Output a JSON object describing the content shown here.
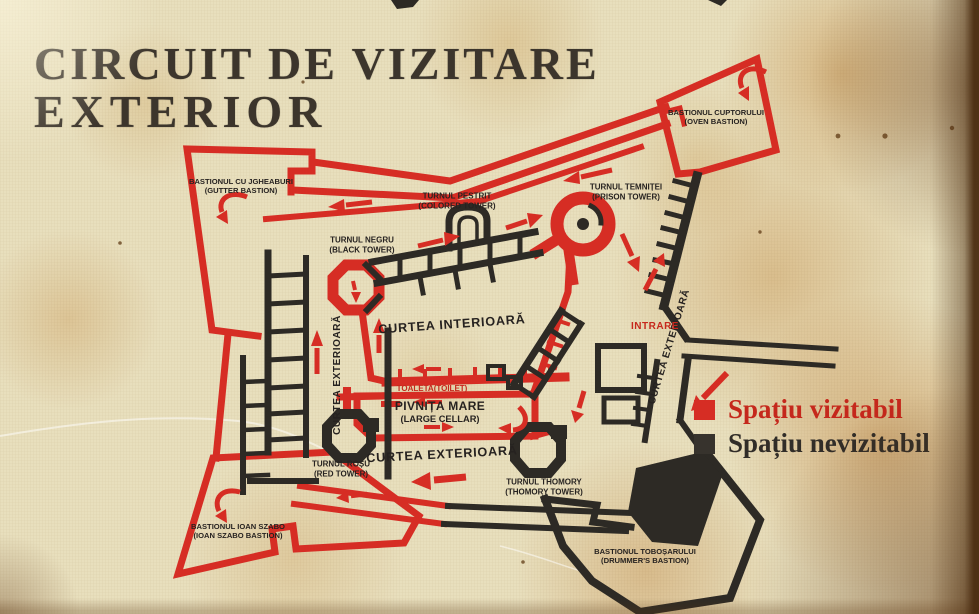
{
  "title": {
    "line1": "CIRCUIT DE VIZITARE",
    "line2": "EXTERIOR"
  },
  "legend": {
    "items": [
      {
        "label": "Spațiu vizitabil",
        "color": "#d62d24"
      },
      {
        "label": "Spațiu nevizitabil",
        "color": "#37332d"
      }
    ]
  },
  "map": {
    "labels": {
      "gutter": {
        "l1": "BASTIONUL CU JGHEABURI",
        "l2": "(GUTTER BASTION)"
      },
      "oven": {
        "l1": "BASTIONUL CUPTORULUI",
        "l2": "(OVEN BASTION)"
      },
      "colored": {
        "l1": "TURNUL PESTRIT",
        "l2": "(COLORED TOWER)"
      },
      "prison": {
        "l1": "TURNUL TEMNIȚEI",
        "l2": "(PRISON TOWER)"
      },
      "black": {
        "l1": "TURNUL NEGRU",
        "l2": "(BLACK TOWER)"
      },
      "red": {
        "l1": "TURNUL ROȘU",
        "l2": "(RED TOWER)"
      },
      "thomory": {
        "l1": "TURNUL THOMORY",
        "l2": "(THOMORY TOWER)"
      },
      "szabo": {
        "l1": "BASTIONUL IOAN SZABO",
        "l2": "(IOAN SZABO BASTION)"
      },
      "drummer": {
        "l1": "BASTIONUL TOBOȘARULUI",
        "l2": "(DRUMMER'S BASTION)"
      },
      "cellar": {
        "l1": "PIVNIȚA MARE",
        "l2": "(LARGE CELLAR)"
      },
      "inner_court": "CURTEA INTERIOARĂ",
      "outer_court_left": "CURTEA EXTERIOARĂ",
      "outer_court_right": "CURTEA EXTERIOARĂ",
      "outer_court_bottom": "CURTEA EXTERIOARĂ",
      "toilet": "TOALETA(TOILET)",
      "entrance": "INTRARE"
    },
    "colors": {
      "visitable": "#d62d24",
      "not_visitable": "#2d2a25",
      "parchment": "#e8dfbd"
    }
  }
}
